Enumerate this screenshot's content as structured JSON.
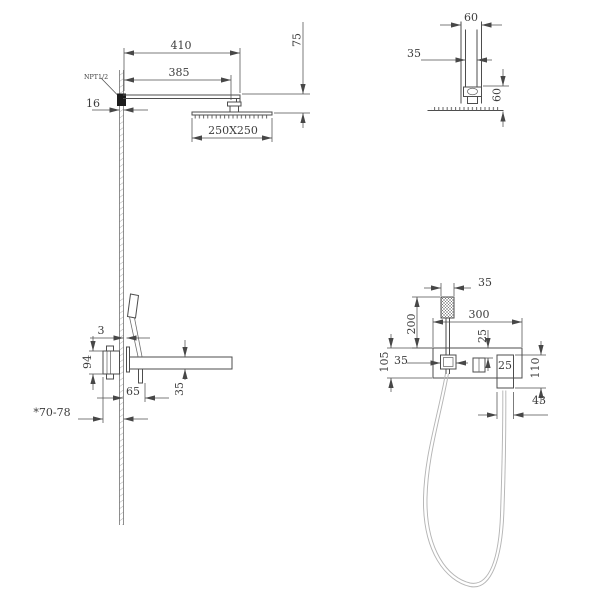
{
  "page": {
    "background": "#ffffff",
    "line_color": "#4d4d4d",
    "hatch_color": "#999999"
  },
  "views": {
    "wall_mounted_head_side": {
      "dims": {
        "arm_length": "410",
        "wall_to_head_center": "385",
        "head_drop": "75",
        "wall_thickness": "16",
        "head_size": "250X250"
      },
      "labels": {
        "thread": "NPT1/2"
      }
    },
    "ceiling_mount_detail": {
      "dims": {
        "outer_width": "60",
        "pipe_width": "35",
        "drop_height": "60"
      }
    },
    "concealed_valve_side": {
      "dims": {
        "plate_offset": "3",
        "valve_height": "94",
        "spout_reach": "65",
        "spout_height": "35",
        "in_wall_depth": "*70-78"
      }
    },
    "hand_shower_front": {
      "dims": {
        "head_width": "35",
        "handle_length": "200",
        "plate_width": "300",
        "outlet_drop": "25",
        "holder_width": "35",
        "plate_height": "105",
        "elbow_size": "25",
        "elbow_height": "110",
        "elbow_width": "43"
      }
    }
  }
}
